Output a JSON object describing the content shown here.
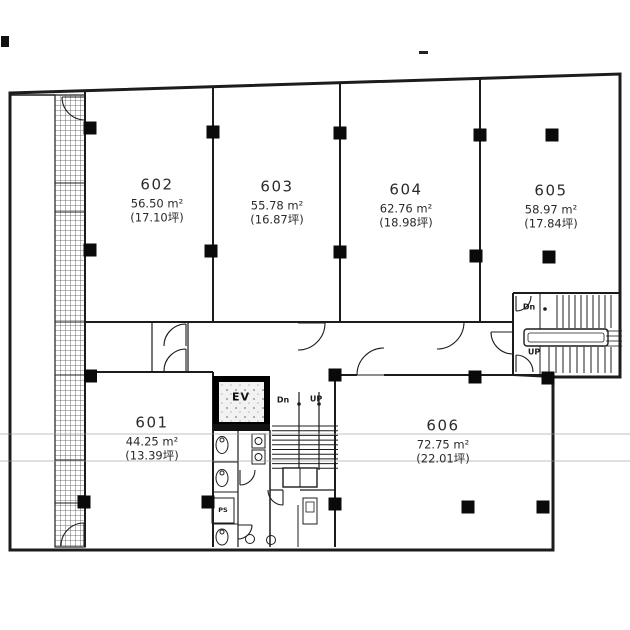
{
  "colors": {
    "line": "#1c1c1c",
    "background": "#ffffff",
    "column_fill": "#0a0a0a",
    "scan_artifact": "#9a9a9a"
  },
  "rooms": [
    {
      "number": "601",
      "area": "44.25 m²",
      "tsubo": "(13.39坪)"
    },
    {
      "number": "602",
      "area": "56.50 m²",
      "tsubo": "(17.10坪)"
    },
    {
      "number": "603",
      "area": "55.78 m²",
      "tsubo": "(16.87坪)"
    },
    {
      "number": "604",
      "area": "62.76 m²",
      "tsubo": "(18.98坪)"
    },
    {
      "number": "605",
      "area": "58.97 m²",
      "tsubo": "(17.84坪)"
    },
    {
      "number": "606",
      "area": "72.75 m²",
      "tsubo": "(22.01坪)"
    }
  ],
  "labels": {
    "elevator": "EV",
    "pipe_space": "PS",
    "stairs_center": {
      "down": "Dn",
      "up": "UP"
    },
    "stairs_right": {
      "down": "Dn",
      "up": "UP"
    }
  }
}
